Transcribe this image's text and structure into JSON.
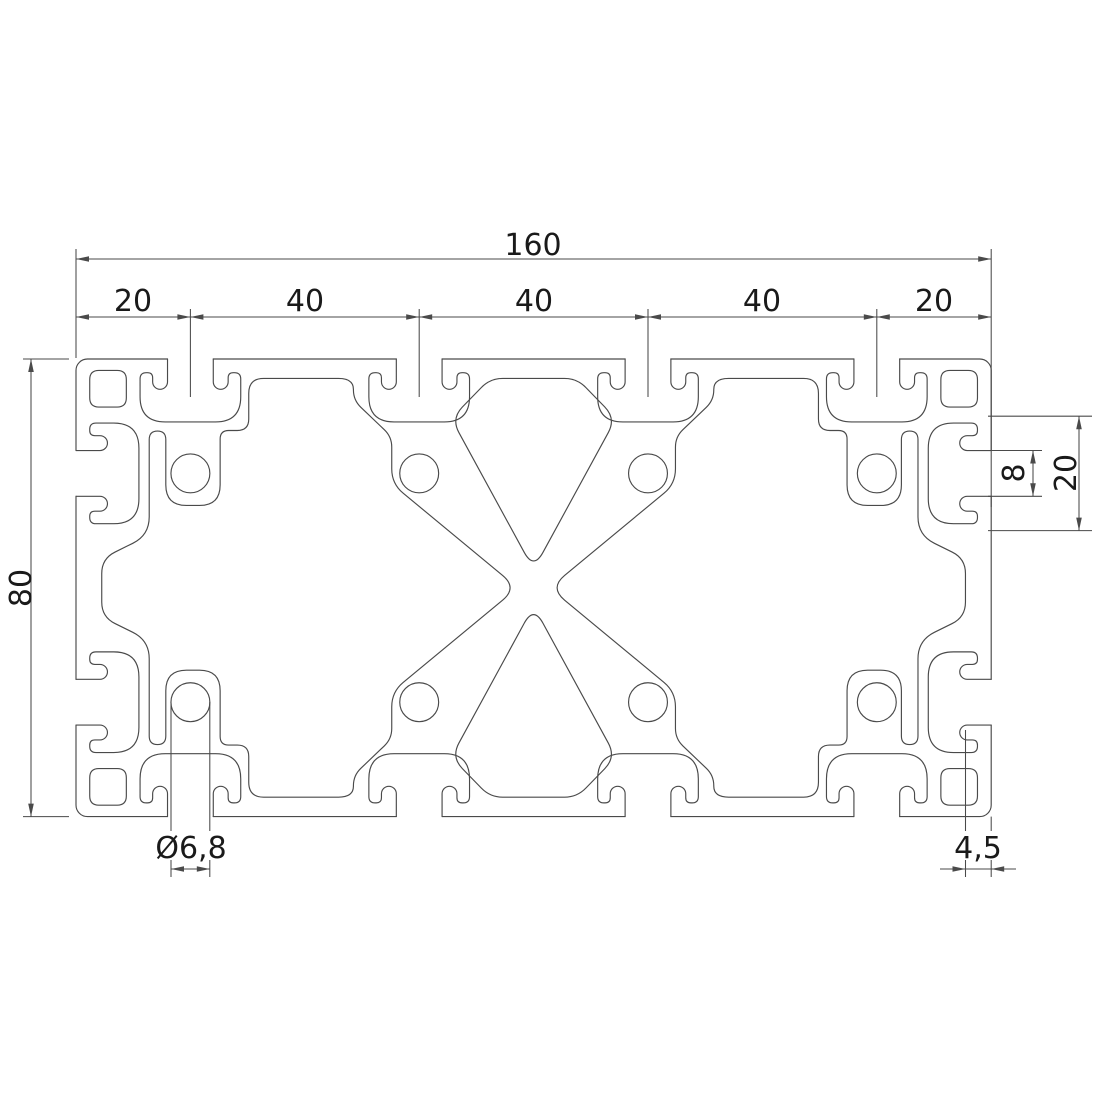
{
  "drawing": {
    "type": "aluminium-extrusion-profile-cross-section",
    "background": "#ffffff",
    "line_color": "#4a4a4a",
    "text_color": "#1a1a1a",
    "dimensions": {
      "total_width": "160",
      "segments": [
        "20",
        "40",
        "40",
        "40",
        "20"
      ],
      "height": "80",
      "slot_pitch": "20",
      "slot_opening": "8",
      "hole_diameter": "Ø6,8",
      "wall_thickness": "4,5"
    }
  }
}
